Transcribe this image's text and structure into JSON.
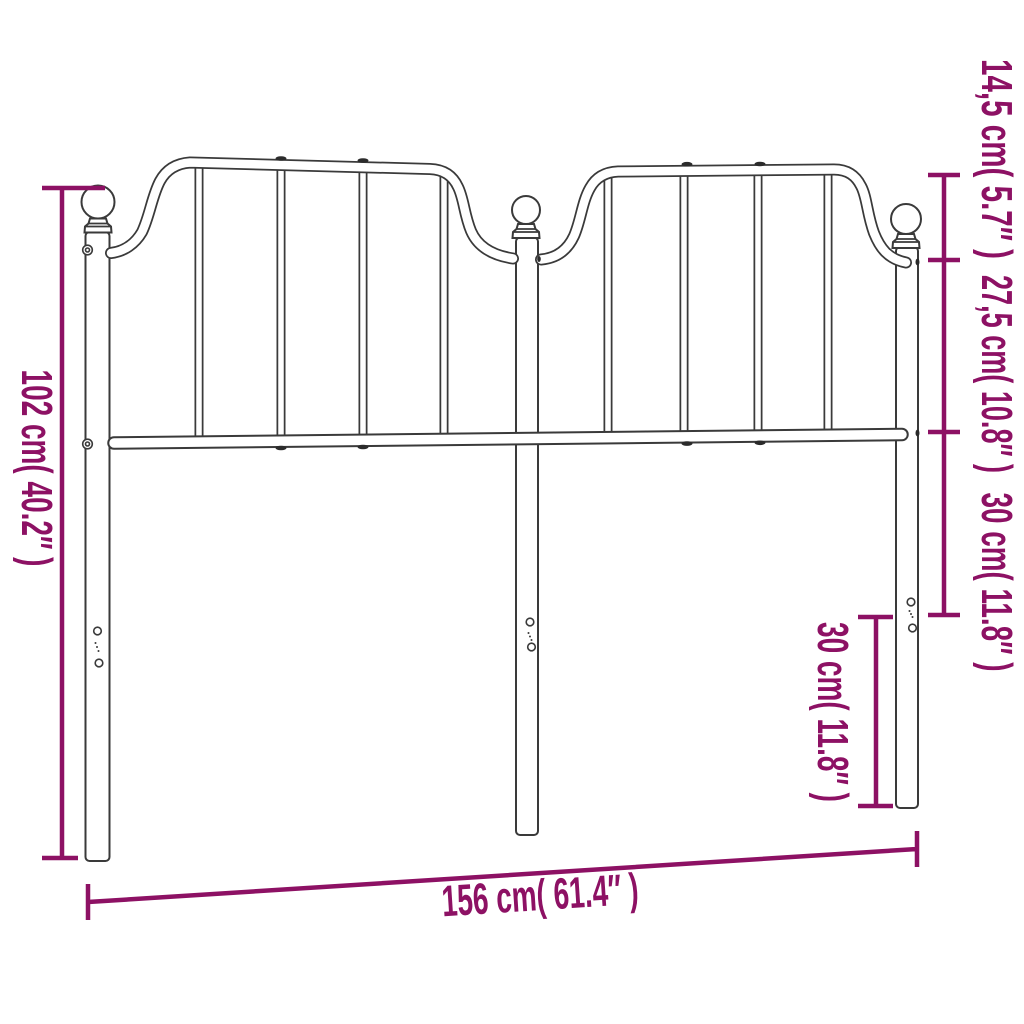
{
  "diagram": {
    "subject": "metal headboard dimension drawing",
    "accent_color": "#8D1164",
    "line_color": "#3A3A3A",
    "background_color": "#FFFFFF",
    "dimensions": {
      "total_height": "102 cm( 40.2″ )",
      "total_width": "156 cm( 61.4″ )",
      "top_curve_height": "14,5 cm( 5.7″ )",
      "panel_height": "27,5 cm( 10.8″ )",
      "lower_section_height": "30 cm( 11.8″ )",
      "leg_height": "30 cm( 11.8″ )"
    }
  }
}
